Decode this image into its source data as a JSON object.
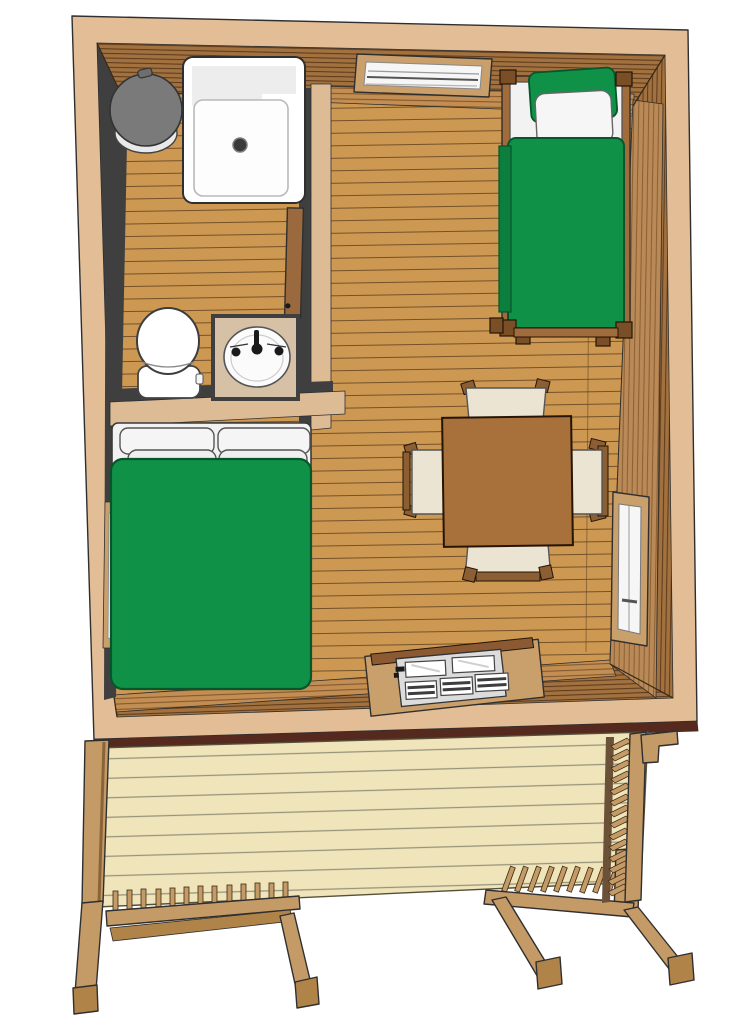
{
  "scene": {
    "kind": "3d-model-top-down-floor-plan",
    "subject": "tiny cabin with bathroom, beds, dining table and front deck"
  },
  "palette": {
    "outline": "#2f2f2f",
    "eave": "#e2bd96",
    "roofEdge": "#55291e",
    "wallTop": "#a1713f",
    "wallTopLine": "#553317",
    "wallLit": "#c28e53",
    "wallLitLine": "#7f5224",
    "wallRightFace": "#b98a57",
    "wallRightLine": "#86592c",
    "wallShadow": "#3f3f3f",
    "partitionTop": "#ddbb94",
    "floor": "#cd9852",
    "floorLine": "#5d4020",
    "frame": "#c9a06b",
    "glass": "#f6f6f6",
    "bedGreen": "#0f9148",
    "bedGreenDark": "#0c7e3e",
    "bedGreenEdge": "#07552b",
    "linen": "#f2f2f2",
    "linenShade": "#dedede",
    "bedWood": "#a06c3c",
    "bedWoodDark": "#7a4e26",
    "table": "#a8703b",
    "chairSeat": "#ebe4d3",
    "chairWood": "#8b5e34",
    "counter": "#d6c1a6",
    "fixtureWhite": "#ffffff",
    "fixtureShade": "#ededed",
    "trashGray": "#7a7a7a",
    "trashBody": "#e9e9e9",
    "doorBrown": "#9a6a3e",
    "doorLeaf": "#dcdcdc",
    "slat": "#3d3d3d",
    "deck": "#f0e4ba",
    "deckLine": "#97937b",
    "deckWood": "#c49a67",
    "deckWoodDark": "#b08449",
    "deckShadow": "#6b5137",
    "black": "#1a1a1a"
  },
  "objects": {
    "bathroom": [
      "shower-pan",
      "waste-bin",
      "toilet",
      "vanity-counter",
      "sink-basin",
      "bathroom-door"
    ],
    "main_room": [
      "double-bed",
      "single-bed",
      "dining-table",
      "chairs"
    ],
    "openings": [
      "top-wall-window",
      "right-wall-window",
      "left-wall-window",
      "entry-glass-door"
    ],
    "deck": [
      "deck-floor",
      "left-post",
      "left-railing",
      "right-railing",
      "side-railing"
    ]
  },
  "counts": {
    "double_bed_pillows": 4,
    "single_bed_pillows": 2,
    "chairs": 4,
    "door_panes_top": 2,
    "door_panes_bottom": 3,
    "left_railing_balusters": 13,
    "right_railing_balusters": 9,
    "side_railing_balusters": 14
  }
}
